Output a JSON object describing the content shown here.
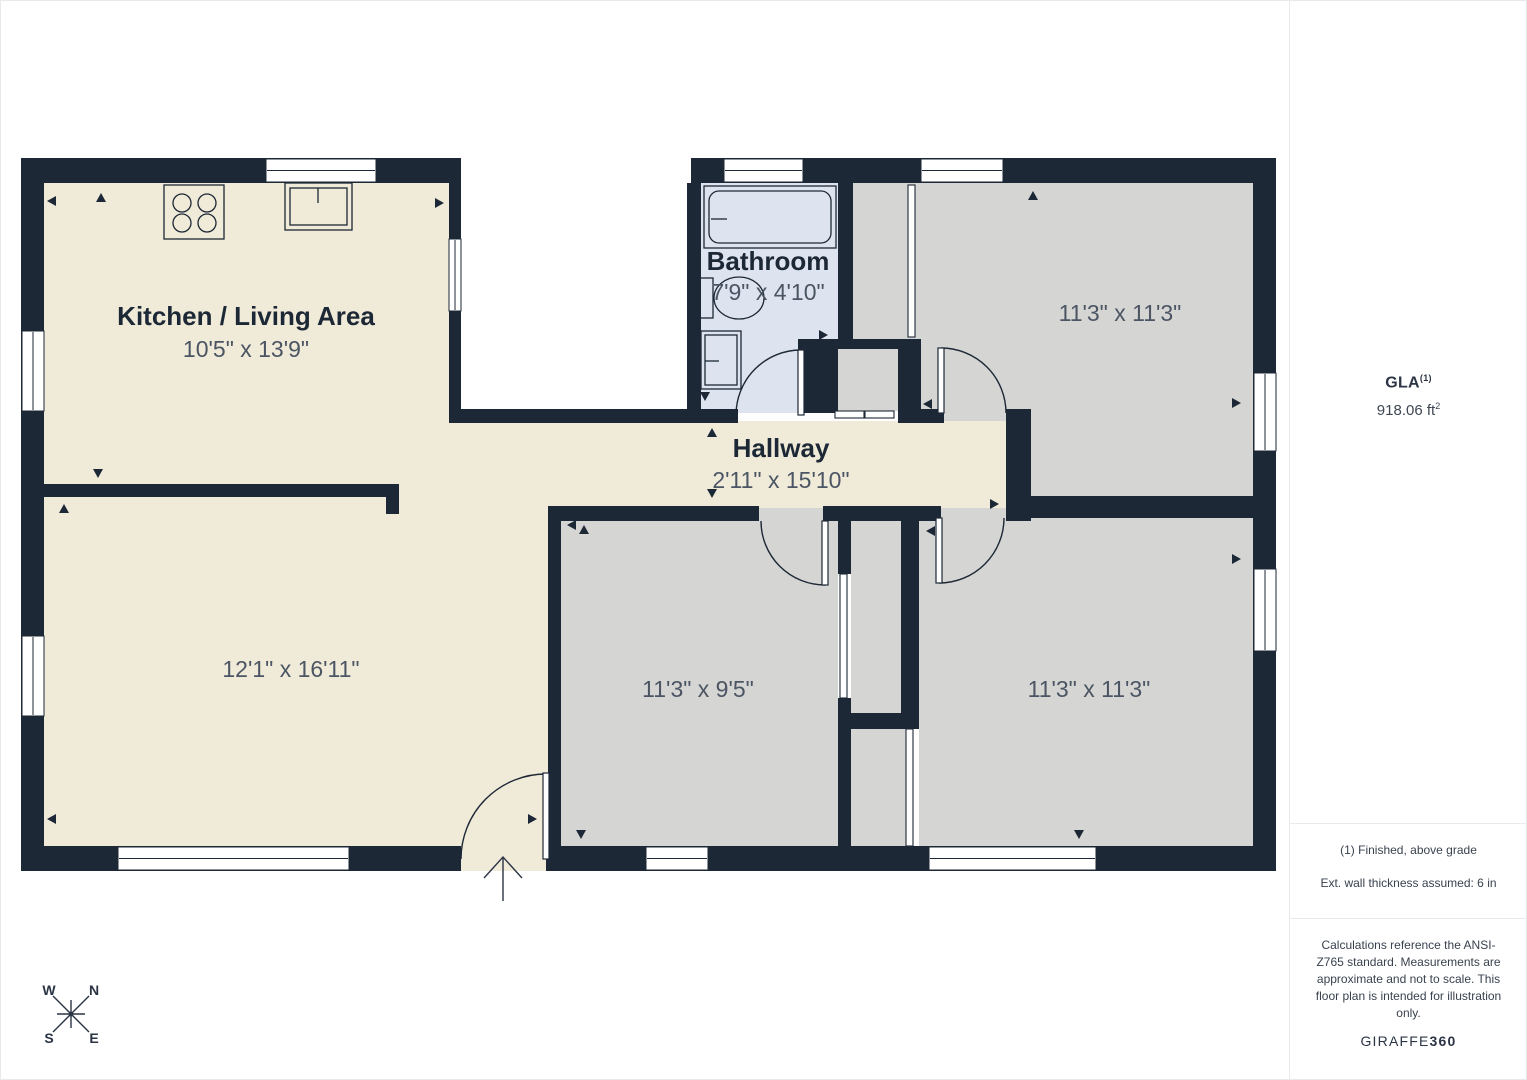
{
  "floorplan": {
    "rooms": [
      {
        "name": "Kitchen / Living Area",
        "dimensions": "10'5\" x 13'9\""
      },
      {
        "name": "",
        "dimensions": "12'1\" x 16'11\""
      },
      {
        "name": "Bathroom",
        "dimensions": "7'9\" x 4'10\""
      },
      {
        "name": "Hallway",
        "dimensions": "2'11\" x 15'10\""
      },
      {
        "name": "",
        "dimensions": "11'3\" x 11'3\""
      },
      {
        "name": "",
        "dimensions": "11'3\" x 9'5\""
      },
      {
        "name": "",
        "dimensions": "11'3\" x 11'3\""
      }
    ],
    "compass": {
      "n": "N",
      "s": "S",
      "e": "E",
      "w": "W"
    }
  },
  "sidebar": {
    "gla_label": "GLA",
    "gla_superscript": "(1)",
    "gla_value": "918.06 ft",
    "gla_value_superscript": "2",
    "note_finished": "(1) Finished, above grade",
    "note_wall_thickness": "Ext. wall thickness assumed: 6 in",
    "disclaimer": "Calculations reference the ANSI-Z765 standard. Measurements are approximate and not to scale. This floor plan is intended for illustration only.",
    "brand_primary": "GIRAFFE",
    "brand_secondary": "360"
  },
  "colors": {
    "walls": "#1d2836",
    "floor_main": "#f0ead8",
    "floor_bedroom": "#d5d5d3",
    "floor_bathroom": "#dee4ef",
    "text_primary": "#1d2836",
    "text_dimensions": "#4b5563",
    "divider": "#e9eaec"
  }
}
